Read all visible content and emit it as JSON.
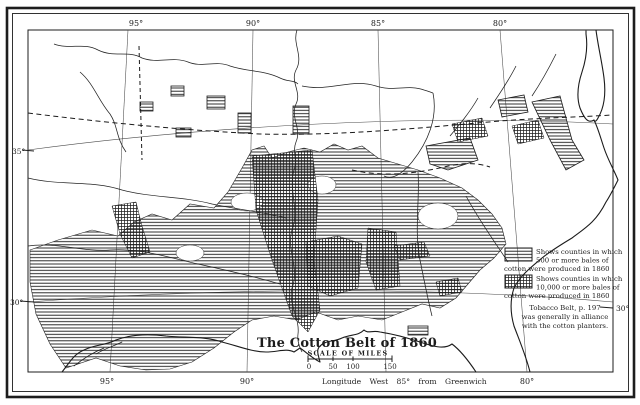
{
  "colors": {
    "ink": "#1d1d1d",
    "paper": "#ffffff"
  },
  "graticule": {
    "top_labels": [
      "95°",
      "90°",
      "85°",
      "80°"
    ],
    "bottom_labels": [
      "95°",
      "90°",
      "80°"
    ],
    "left_labels": [
      "35°",
      "30°"
    ],
    "right_labels": [
      "30°"
    ],
    "bottom_caption": "Longitude West 85° from Greenwich"
  },
  "title_block": {
    "title": "The Cotton Belt of 1860",
    "scale_label": "SCALE OF MILES",
    "scale_ticks": [
      "0",
      "50",
      "100",
      "150"
    ]
  },
  "legend": {
    "items": [
      {
        "swatch": "horizontal-line-hatch",
        "lines": [
          "Shows counties in which",
          "500 or more bales of",
          "cotton were produced in 1860"
        ]
      },
      {
        "swatch": "dense-grid-hatch",
        "lines": [
          "Shows counties in which",
          "10,000 or more bales of",
          "cotton were produced in 1860"
        ]
      }
    ],
    "note_lines": [
      "Tobacco Belt, p. 197",
      "was generally in alliance",
      "with the cotton planters."
    ]
  }
}
